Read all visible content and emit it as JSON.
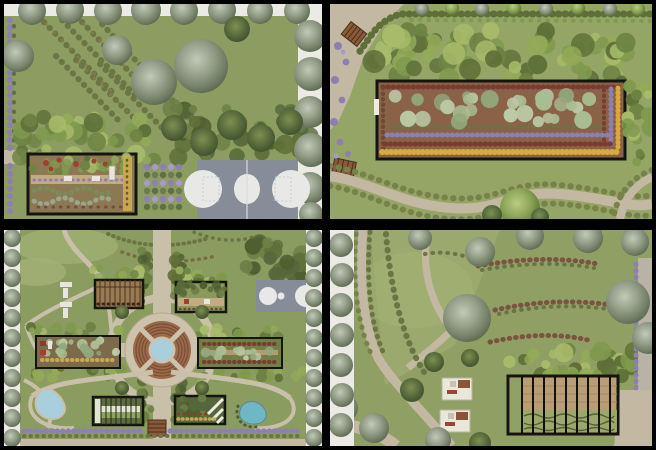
{
  "canvas": {
    "width": 656,
    "height": 450,
    "background": "#000000",
    "description": "2x2 collage of four top-down landscape architecture plan renderings separated by black dividers"
  },
  "palette": {
    "colors": {
      "frame": "#000000",
      "lawn1": "#8d9d62",
      "lawn2": "#95a566",
      "lawn3": "#8b9c60",
      "lawn4": "#90a065",
      "lawnLight": "#a7b377",
      "whiteStrip": "#eceae4",
      "road": "#b9b3a6",
      "pathTan": "#c3b9a3",
      "pathLight": "#c9c0aa",
      "plaza": "#cdc3ac",
      "court": "#868d98",
      "courtLine": "#e8e8e6",
      "soil": "#8a6248",
      "soilLight": "#8a7952",
      "gardenPath": "#c3ac82",
      "outline": "#151510",
      "purple": "#8d7fae",
      "purpleLight": "#a79ac4",
      "yellow": "#cfa43e",
      "maroon": "#7a3c30",
      "red": "#a04030",
      "sage": "#a9bd92",
      "pool": "#a9cfdd",
      "poolDeep": "#6fb7c4",
      "brick": "#9a6a4a",
      "brickLine": "#7a4e34",
      "wood": "#9a7a52",
      "woodLight": "#b99d76",
      "woodDark": "#4a3520",
      "white2": "#e9e6da",
      "olive": "#6b7444",
      "shrubBrown": "#7a5440",
      "ghDark": "#5d6b3f",
      "ghWhite": "#e0e5d2",
      "bench": "#8a5a38"
    },
    "scatter": {
      "forest": [
        "#7f9a4e",
        "#93aa58",
        "#5e7038",
        "#a8bb6a",
        "#6d8343"
      ],
      "darkLeaf": [
        "#5e7038",
        "#4e5f30",
        "#6d8046",
        "#56683a"
      ],
      "sageSet": [
        "#a9bd92",
        "#93a87c",
        "#bccaa6"
      ],
      "grayTree": [
        "#97a18c",
        "#aab3a0",
        "#7e8a74"
      ]
    }
  },
  "panels": [
    {
      "id": "top-left",
      "label": "Park plan: lawn with diagonal hedgerows, street tree rows, basketball court and sunken flower garden",
      "features": [
        "street-tree-row",
        "diagonal-hedgerows",
        "canopy-trees",
        "basketball-court",
        "purple-parterre-grid",
        "sunken-garden"
      ]
    },
    {
      "id": "top-right",
      "label": "Plan: long rectangular flower parterre framed in black with forest belt above and winding gravel path below",
      "features": [
        "entry-plaza",
        "wood-decks",
        "forest-belt",
        "flower-parterre",
        "lavender-and-marigold-borders",
        "winding-path"
      ]
    },
    {
      "id": "bottom-left",
      "label": "Formal garden plan: circular amphitheater plaza with pool, axial paths, four garden pavilions, two ponds and small court",
      "features": [
        "tree-allees",
        "amphitheater-plaza",
        "central-pool",
        "pergola",
        "greenhouse",
        "flower-beds",
        "ponds",
        "court",
        "steps"
      ]
    },
    {
      "id": "bottom-right",
      "label": "Plan: open meadow with curving gravel paths, shrub arcs, picnic decks and slatted-roof pergola garden",
      "features": [
        "meadow",
        "curved-paths",
        "shrub-arcs",
        "canopy-trees",
        "picnic-decks",
        "slatted-pergola",
        "side-road"
      ]
    }
  ]
}
